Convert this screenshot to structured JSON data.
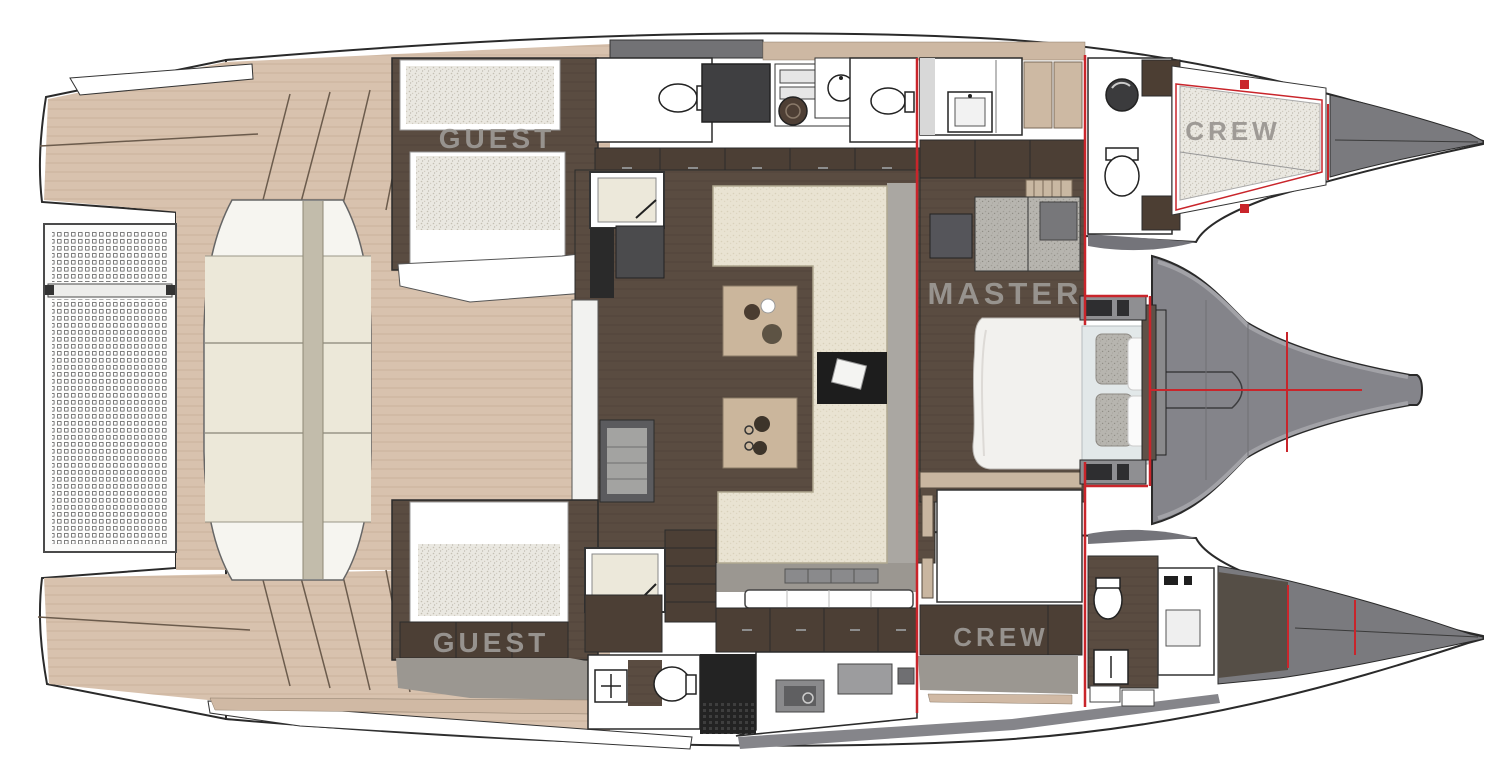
{
  "plan": {
    "type": "yacht-floor-plan",
    "vessel": "catamaran",
    "cabins": {
      "guest_port": {
        "label": "GUEST"
      },
      "crew_port": {
        "label": "CREW"
      },
      "master": {
        "label": "MASTER"
      },
      "crew_starboard": {
        "label": "CREW"
      },
      "guest_starboard": {
        "label": "GUEST"
      }
    },
    "palette": {
      "bulkhead_red": "#c9252b",
      "teak_deck": "#d8c2ae",
      "interior_floor": "#5a4c41",
      "cabinetry_brown": "#4c3f35",
      "hull_gray": "#84848a",
      "bow_deck_gray": "#7a7a7e",
      "upholstery_cream": "#e9e3d2",
      "sunpad_cream": "#ece8d9",
      "label_gray": "#9b9793"
    }
  }
}
